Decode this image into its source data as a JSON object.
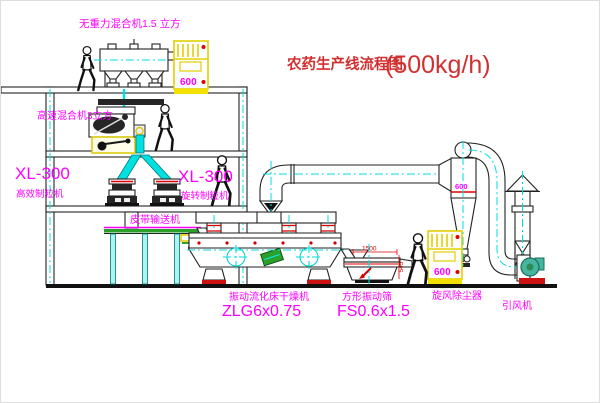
{
  "title": {
    "name": "农药生产线流程图",
    "capacity": "(500kg/h)"
  },
  "labels": {
    "gravity_free_mixer": "无重力混合机1.5 立方",
    "high_speed_mixer": "高速混合机3立方",
    "granulator_left_model": "XL-300",
    "granulator_left_name": "高效制粒机",
    "granulator_right_model": "XL-300",
    "granulator_right_name": "旋转制粒机",
    "belt_conveyor": "皮带输送机",
    "dryer_name": "振动流化床干燥机",
    "dryer_model": "ZLG6x0.75",
    "sieve_name": "方形振动筛",
    "sieve_model": "FS0.6x1.5",
    "cyclone": "旋风除尘器",
    "fan": "引风机"
  },
  "dimensions": {
    "cyclone_body": "600",
    "sieve_length": "1500",
    "sieve_height": "545"
  },
  "cabinets": {
    "cabinet1_readout": "600",
    "cabinet2_readout": "600"
  },
  "colors": {
    "magenta": "#ff00ff",
    "title_red": "#d23030",
    "dim_red": "#e00000",
    "centerline_cyan": "#00dede",
    "cabinet_yellow": "#f3df00",
    "line_black": "#222222"
  }
}
